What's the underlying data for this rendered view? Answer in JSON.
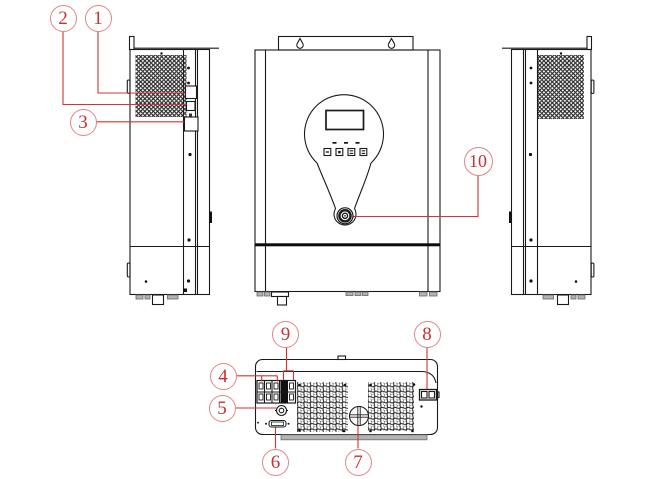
{
  "callouts": [
    {
      "number": "1"
    },
    {
      "number": "2"
    },
    {
      "number": "3"
    },
    {
      "number": "4"
    },
    {
      "number": "5"
    },
    {
      "number": "6"
    },
    {
      "number": "7"
    },
    {
      "number": "8"
    },
    {
      "number": "9"
    },
    {
      "number": "10"
    }
  ],
  "colors": {
    "line_art": "#1a1a1a",
    "callout_text": "#c9302f",
    "callout_circle": "#e08585",
    "leader_line": "#d23333",
    "foot_gray": "#b3b3b3",
    "background": "#ffffff"
  }
}
